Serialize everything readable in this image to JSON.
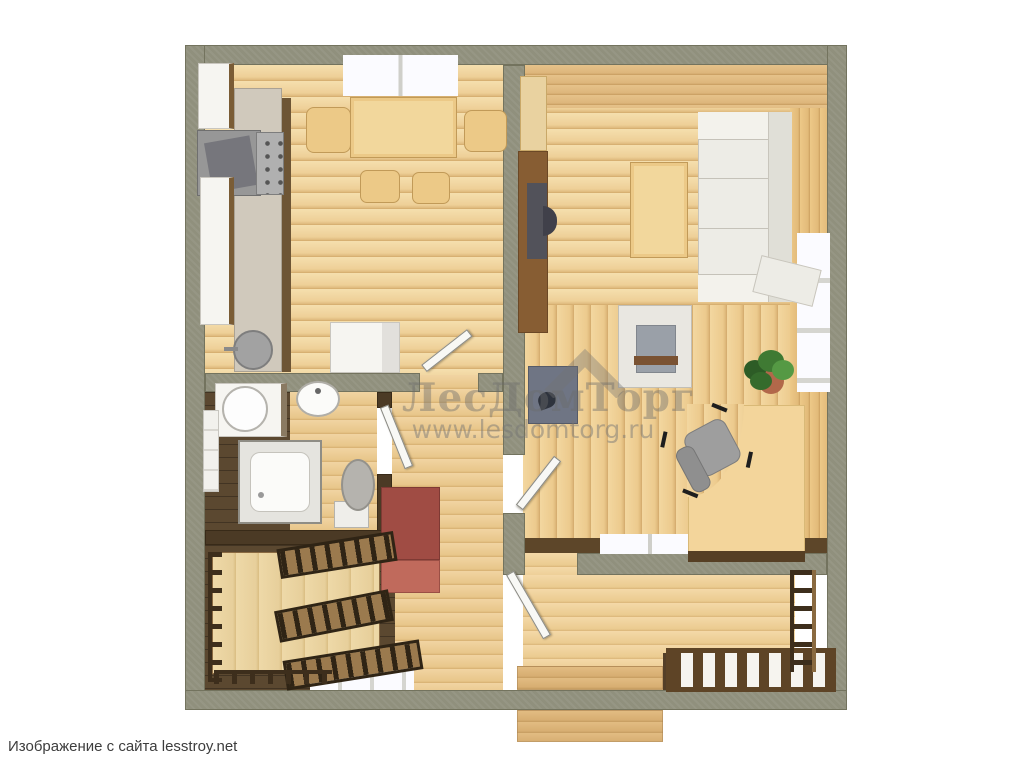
{
  "watermark": {
    "brand": "ЛесДомТорг",
    "url": "www.lesdomtorg.ru"
  },
  "caption": "Изображение с сайта lesstroy.net",
  "colors": {
    "outer_wall": "#90907d",
    "dark_timber": "#4b3a25",
    "floor_wood_light": "#eecf97",
    "floor_wood_dark": "#5b4830",
    "wardrobe_red": "#a04c44",
    "fixture_white": "#f6f5f1",
    "desk_tan": "#f3d59b",
    "fireplace_slate": "#6f7584",
    "plant_green": "#3f7a33",
    "background": "#ffffff"
  }
}
